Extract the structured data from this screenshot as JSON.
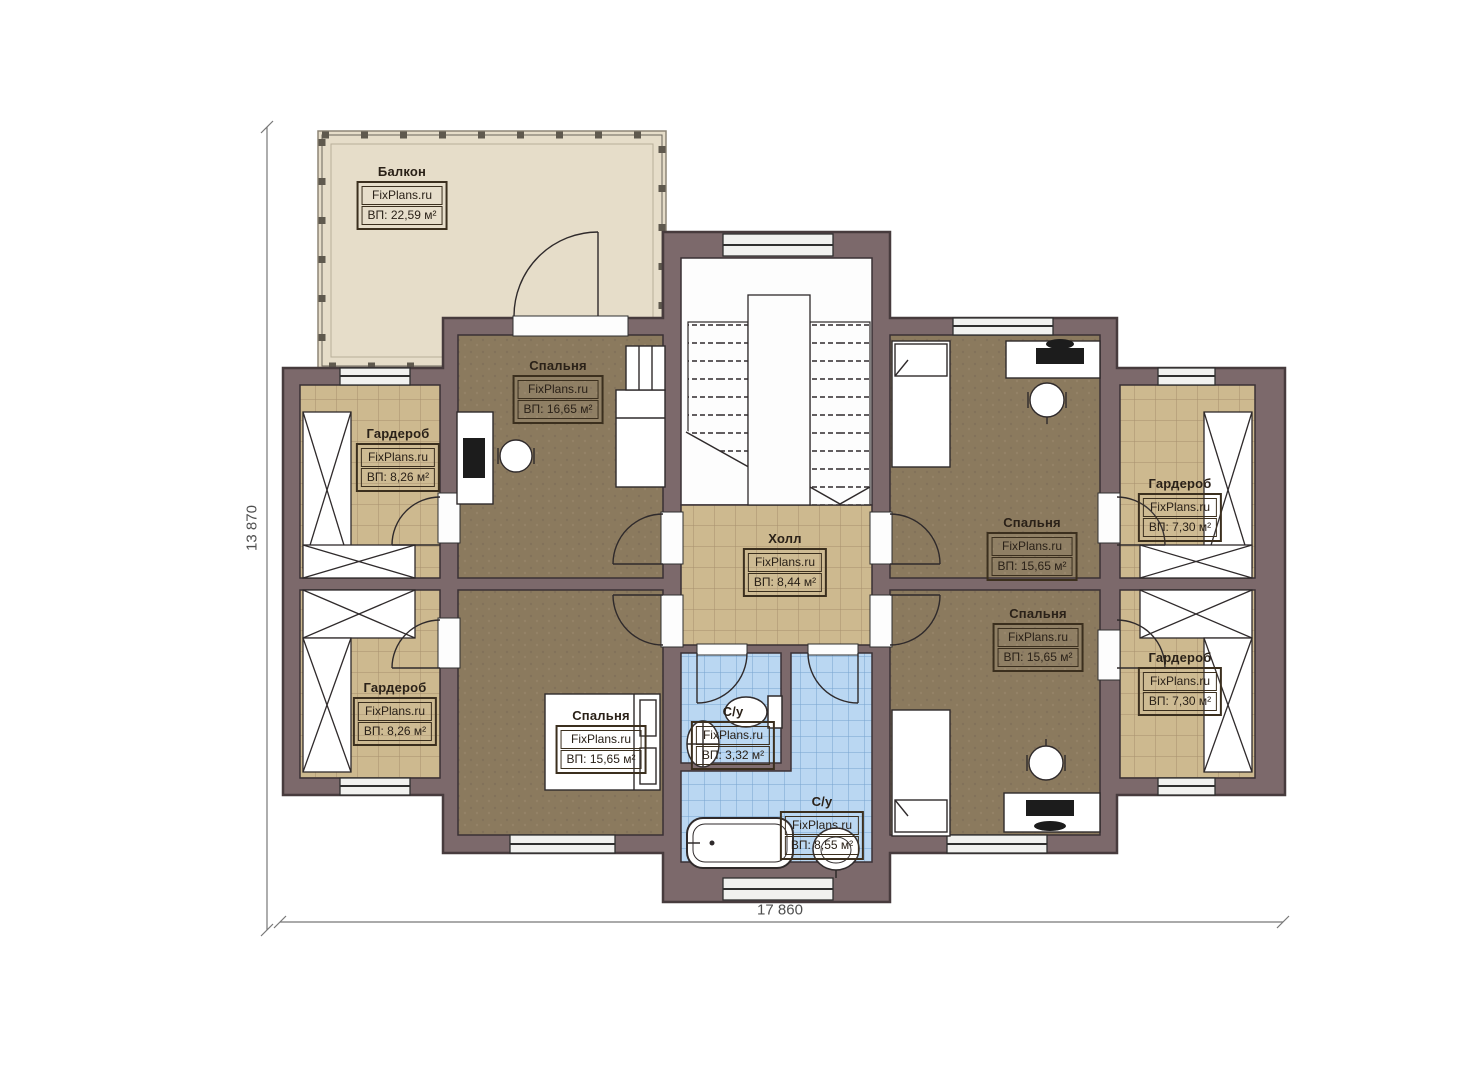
{
  "watermark": "FixPlans.ru",
  "dimensions": {
    "horizontal": "17 860",
    "vertical": "13 870"
  },
  "rooms": {
    "balcony": {
      "name": "Балкон",
      "area": "ВП: 22,59 м²"
    },
    "bedroom_tl": {
      "name": "Спальня",
      "area": "ВП: 16,65 м²"
    },
    "wardrobe_lt": {
      "name": "Гардероб",
      "area": "ВП: 8,26 м²"
    },
    "wardrobe_lb": {
      "name": "Гардероб",
      "area": "ВП: 8,26 м²"
    },
    "bedroom_bl": {
      "name": "Спальня",
      "area": "ВП: 15,65 м²"
    },
    "hall": {
      "name": "Холл",
      "area": "ВП: 8,44 м²"
    },
    "bath_small": {
      "name": "С/у",
      "area": "ВП: 3,32 м²"
    },
    "bath_big": {
      "name": "С/у",
      "area": "ВП: 8,55 м²"
    },
    "bedroom_tr": {
      "name": "Спальня",
      "area": "ВП: 15,65 м²"
    },
    "bedroom_br": {
      "name": "Спальня",
      "area": "ВП: 15,65 м²"
    },
    "wardrobe_rt": {
      "name": "Гардероб",
      "area": "ВП: 7,30 м²"
    },
    "wardrobe_rb": {
      "name": "Гардероб",
      "area": "ВП: 7,30 м²"
    }
  },
  "colors": {
    "wall": "#7c696b",
    "wall_outline": "#473b3d",
    "balcony_floor": "#e6ddc9",
    "tile_floor": "#cdb98f",
    "tile_grid": "#a68f6e",
    "carpet_floor": "#8b7a5e",
    "bath_tile": "#bad7f2",
    "bath_grid": "#76a3cf",
    "label_ink": "#2a2118",
    "dimension_ink": "#4f4f4f"
  }
}
